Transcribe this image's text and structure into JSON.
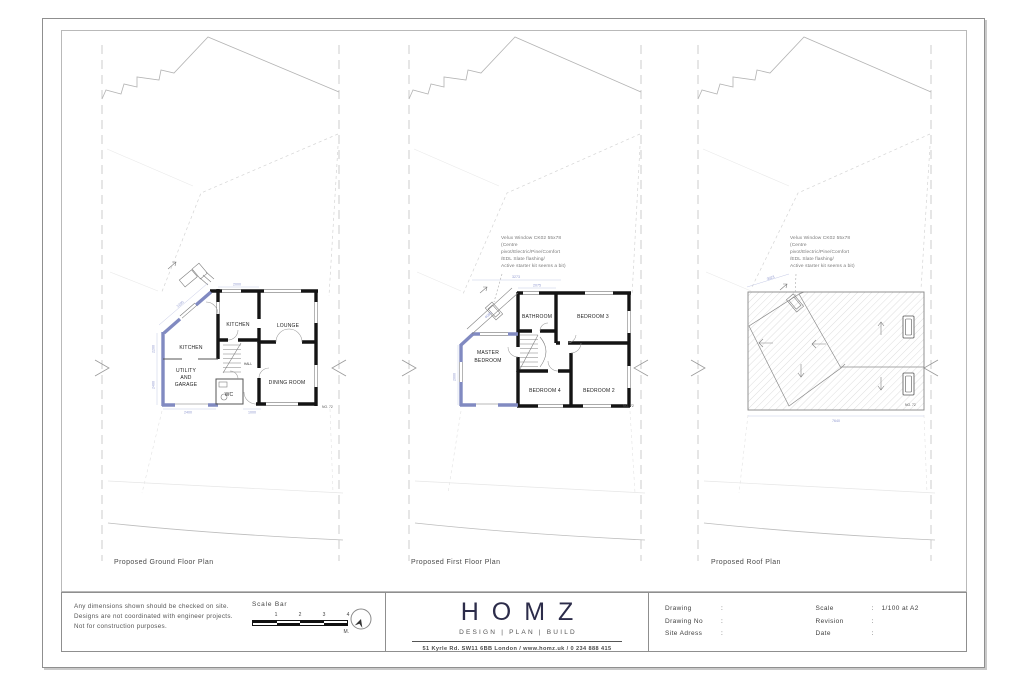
{
  "panels": [
    {
      "title": "Proposed Ground Floor Plan",
      "house_no": "NO. 72",
      "rooms": {
        "kitchen_top": "KITCHEN",
        "lounge": "LOUNGE",
        "kitchen_left": "KITCHEN",
        "utility1": "UTILITY",
        "utility2": "AND",
        "utility3": "GARAGE",
        "wc": "WC",
        "hall": "HALL",
        "dining": "DINING ROOM"
      },
      "dims": [
        "2200",
        "2200",
        "2400",
        "2400",
        "2000",
        "1000"
      ]
    },
    {
      "title": "Proposed First Floor Plan",
      "house_no": "NO. 72",
      "annotation": [
        "Velux Window CK02 55x78",
        "(Centre",
        "pivot/Electric/Pine/Comfort",
        "/EDL Slate flashing/",
        "Active starter kit seems a bit)"
      ],
      "rooms": {
        "bathroom": "BATHROOM",
        "bedroom3": "BEDROOM 3",
        "master1": "MASTER",
        "master2": "BEDROOM",
        "bedroom4": "BEDROOM 4",
        "bedroom2": "BEDROOM 2"
      },
      "dims": [
        "3273",
        "4080",
        "2075",
        "2000"
      ]
    },
    {
      "title": "Proposed Roof Plan",
      "house_no": "NO. 72",
      "annotation": [
        "Velux Window CK02 55x78",
        "(Centre",
        "pivot/Electric/Pine/Comfort",
        "/EDL Slate flashing/",
        "Active starter kit seems a bit)"
      ],
      "dims": [
        "3023",
        "7640"
      ]
    }
  ],
  "title_block": {
    "notes": [
      "Any dimensions shown should be checked on site.",
      "Designs are not coordinated with engineer projects.",
      "Not for construction purposes."
    ],
    "scale_bar": {
      "label": "Scale Bar",
      "ticks": [
        "1",
        "2",
        "3",
        "4"
      ],
      "unit": "M."
    },
    "brand": {
      "name": "HOMZ",
      "tagline": "DESIGN | PLAN | BUILD",
      "address": "51 Kyrle Rd. SW11 6BB London / www.homz.uk / 0 234 888 415"
    },
    "info": {
      "colon": ":",
      "left": [
        {
          "label": "Drawing",
          "value": ""
        },
        {
          "label": "Drawing No",
          "value": ""
        },
        {
          "label": "Site Adress",
          "value": ""
        }
      ],
      "right": [
        {
          "label": "Scale",
          "value": "1/100 at A2"
        },
        {
          "label": "Revision",
          "value": ""
        },
        {
          "label": "Date",
          "value": ""
        }
      ]
    }
  },
  "colors": {
    "new_wall_blue": "#818ac1",
    "existing_wall_black": "#141414",
    "brand_navy": "#2c2c4a",
    "dimension_blue": "#8f98cf"
  }
}
